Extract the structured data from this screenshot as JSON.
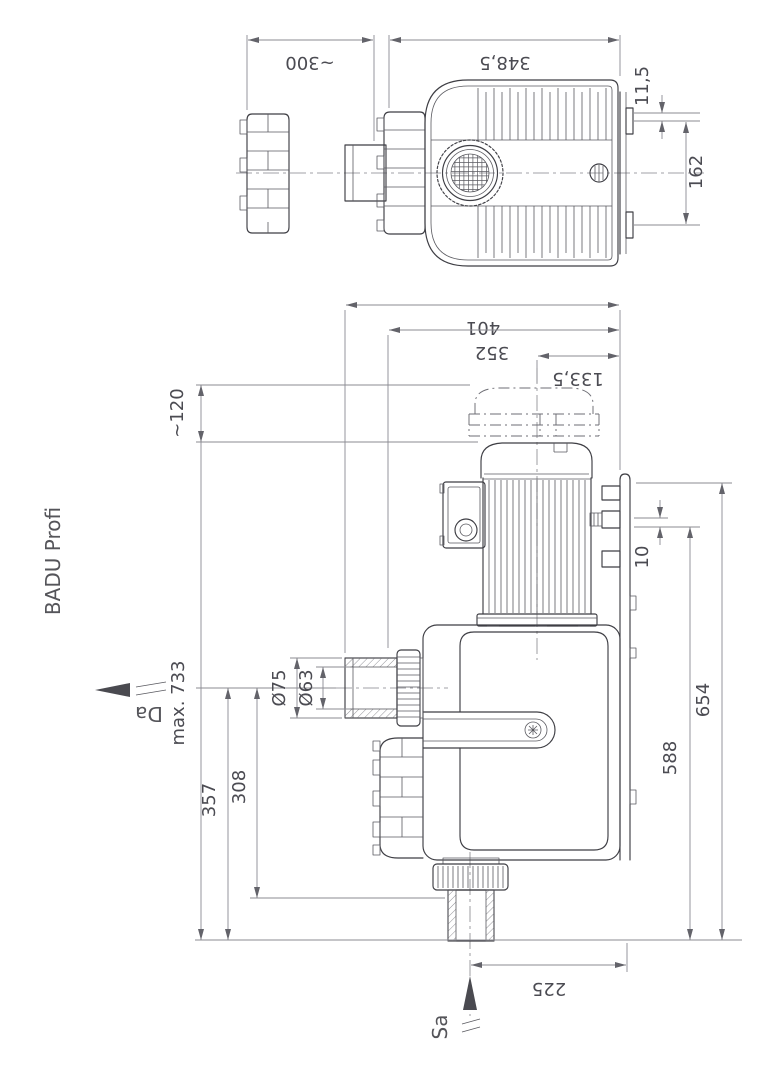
{
  "product": {
    "name": "BADU Profi"
  },
  "flow": {
    "outlet_label": "Da",
    "inlet_label": "Sa"
  },
  "dims": {
    "top": {
      "removal_clearance": "~300",
      "total_length": "348,5",
      "flange_offset": "11,5",
      "bracket_spacing": "162"
    },
    "front": {
      "overall_width": "401",
      "width_to_axis": "352",
      "axis_to_bracket": "133,5",
      "lid_clearance": "~120",
      "max_height": "max. 733",
      "port_outer_dia": "Ø75",
      "port_inner_dia": "Ø63",
      "port_axis_height": "357",
      "union_nut_height": "308",
      "bracket_gap": "10",
      "bracket_height": "588",
      "plate_top_height": "654",
      "inlet_offset": "225"
    }
  }
}
